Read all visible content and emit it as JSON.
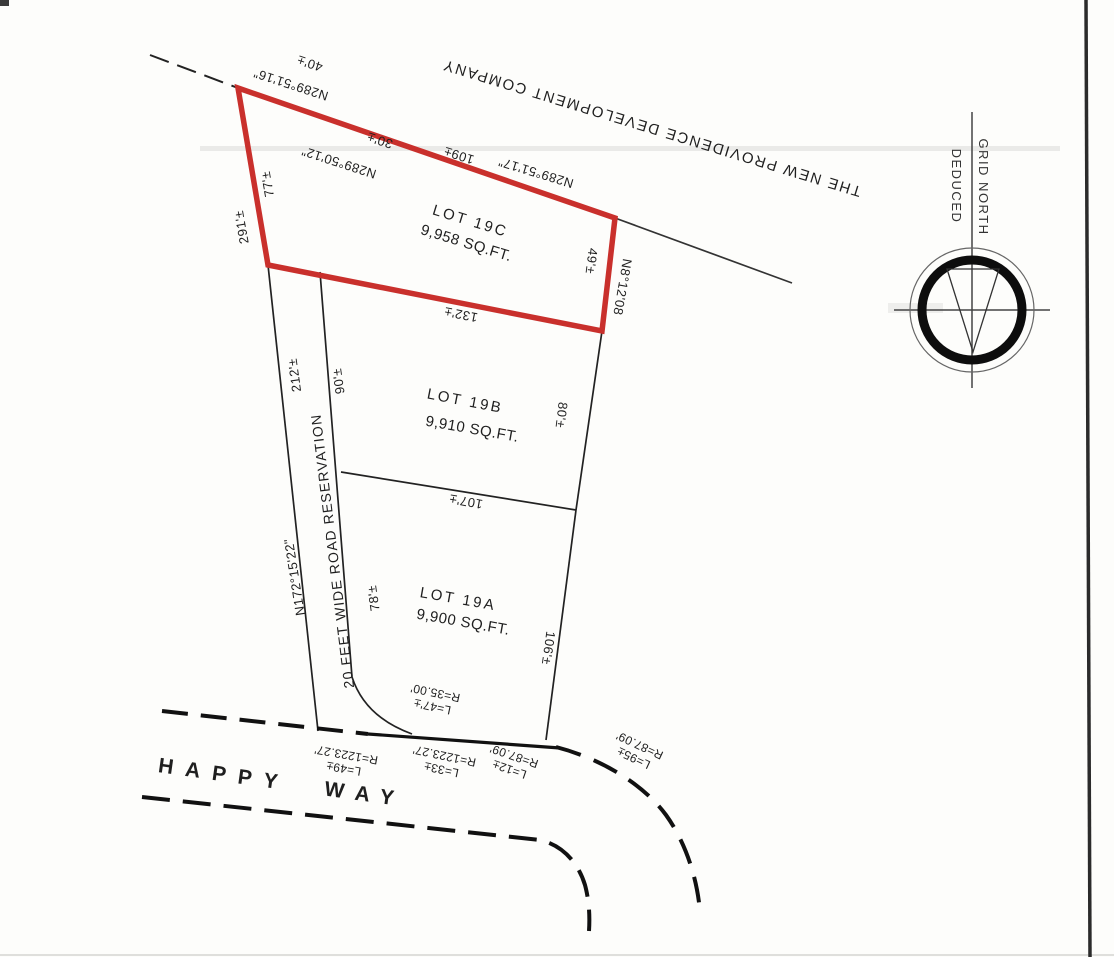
{
  "owner": "THE NEW PROVIDENCE DEVELOPMENT COMPANY",
  "road": {
    "name": "HAPPY WAY",
    "reservation_label": "20 FEET WIDE ROAD RESERVATION",
    "reservation_bearing": "N172°15'22\""
  },
  "lots": [
    {
      "name": "LOT 19C",
      "area": "9,958 SQ.FT."
    },
    {
      "name": "LOT 19B",
      "area": "9,910 SQ.FT."
    },
    {
      "name": "LOT 19A",
      "area": "9,900 SQ.FT."
    }
  ],
  "bearings": {
    "nw": "N289°51'16\"",
    "nw_dist": "40'±",
    "mid": "N289°50'12\"",
    "mid_dist": "30'±",
    "ne": "N289°51'17\"",
    "ne_dist": "109±",
    "east": "N8°12'08"
  },
  "dimensions": {
    "d291": "291'±",
    "d77": "77'±",
    "d49": "49'±",
    "d132": "132'±",
    "d212": "212'±",
    "d90": "90'±",
    "d80": "80'±",
    "d107": "107'±",
    "d78": "78'±",
    "d106": "106'±"
  },
  "curves": {
    "c35": {
      "l": "L=47'±",
      "r": "R=35.00'"
    },
    "c49": {
      "l": "L=49±",
      "r": "R=1223.27'"
    },
    "c33": {
      "l": "L=33±",
      "r": "R=1223.27'"
    },
    "c12": {
      "l": "L=12±",
      "r": "R=87.09'"
    },
    "c95": {
      "l": "L=95±",
      "r": "R=87.09'"
    }
  },
  "compass": {
    "line1": "GRID NORTH",
    "line2": "DEDUCED"
  },
  "colors": {
    "highlight_red": "#c9302c",
    "ink": "#1c1c1c"
  }
}
